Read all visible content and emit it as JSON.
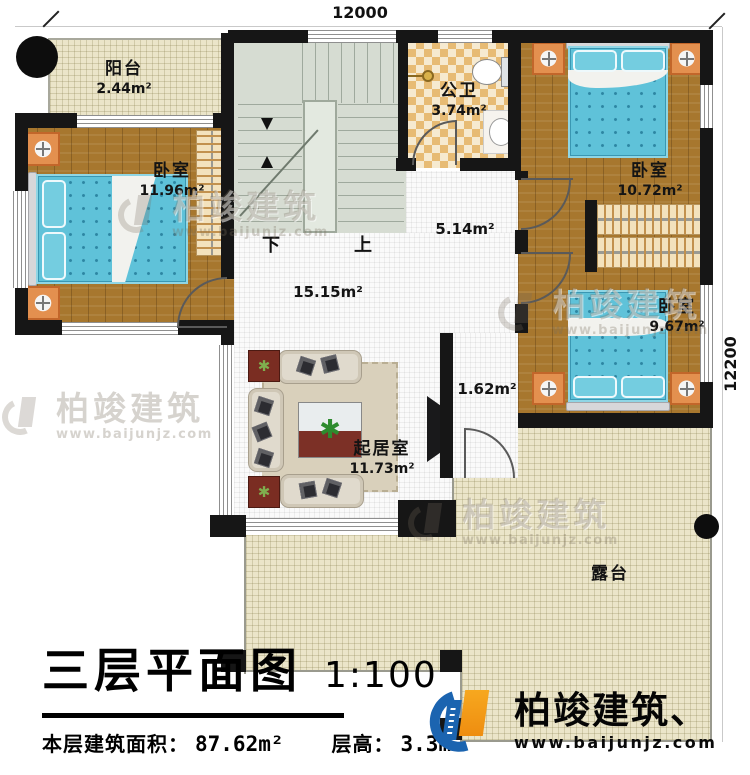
{
  "plan": {
    "dim_top": "12000",
    "dim_right": "12200",
    "rooms": {
      "balcony": {
        "label": "阳台",
        "area": "2.44m²"
      },
      "bedroom_left": {
        "label": "卧室",
        "area": "11.96m²"
      },
      "bathroom": {
        "label": "公卫",
        "area": "3.74m²"
      },
      "bedroom_top_right": {
        "label": "卧室",
        "area": "10.72m²"
      },
      "bedroom_mid_right": {
        "label": "卧室",
        "area": "9.67m²"
      },
      "hallway_area": "5.14m²",
      "open_area": "15.15m²",
      "corridor_area": "1.62m²",
      "living_room": {
        "label": "起居室",
        "area": "11.73m²"
      },
      "terrace": {
        "label": "露台"
      }
    },
    "stairs": {
      "down_label": "下",
      "up_label": "上"
    }
  },
  "title_block": {
    "title": "三层平面图",
    "scale": "1:100",
    "floor_area_label": "本层建筑面积：",
    "floor_area_value": "87.62m²",
    "floor_height_label": "层高：",
    "floor_height_value": "3.3m"
  },
  "branding": {
    "watermark_name": "柏竣建筑",
    "watermark_url": "www.baijunjz.com",
    "logo_name": "柏竣建筑、",
    "logo_url": "www.baijunjz.com"
  },
  "colors": {
    "wall": "#161616",
    "wood_floor": "#a7772e",
    "mattress_blue": "#5fc2d9",
    "tile_cream": "#ebe5c9",
    "bath_checker": "#e7bb74",
    "stair_green": "#d6dcd2",
    "logo_blue": "#1b64b0",
    "logo_orange": "#f7a81f"
  }
}
